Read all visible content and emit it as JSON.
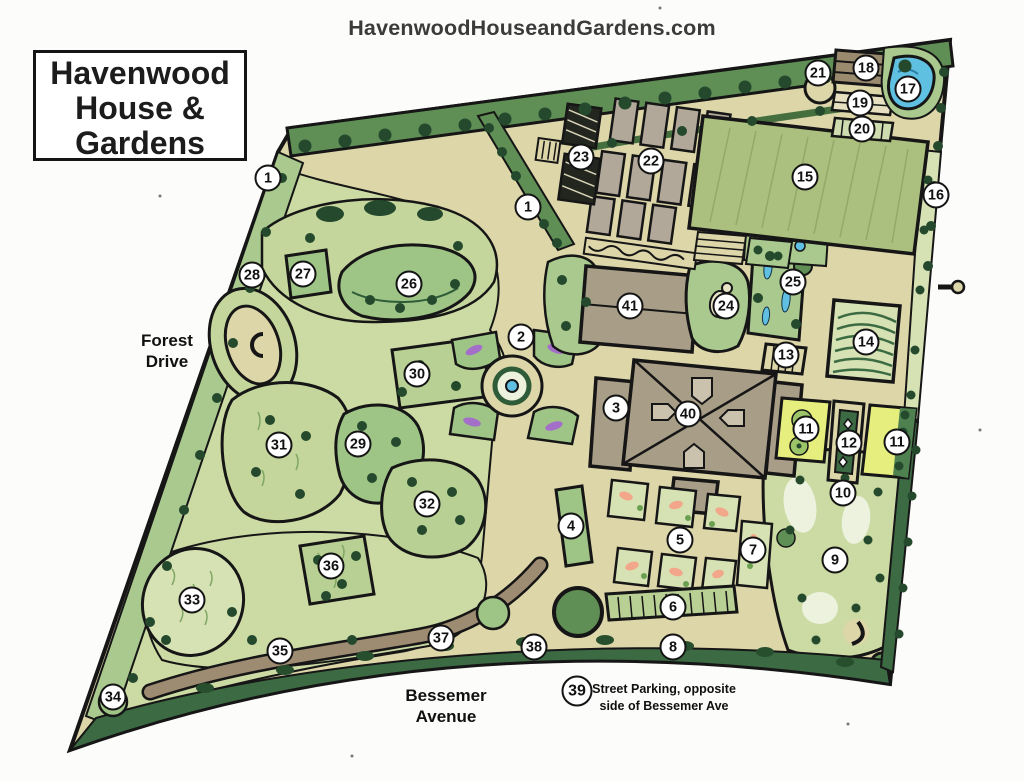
{
  "header": {
    "website": "HavenwoodHouseandGardens.com"
  },
  "title_box": {
    "line1": "Havenwood",
    "line2": "House &",
    "line3": "Gardens"
  },
  "roads": {
    "left": {
      "line1": "Forest",
      "line2": "Drive"
    },
    "bottom": {
      "line1": "Bessemer",
      "line2": "Avenue"
    }
  },
  "note": {
    "number": "39",
    "line1": "Street Parking, opposite",
    "line2": "side of Bessemer Ave"
  },
  "markers": [
    {
      "n": "1",
      "x": 268,
      "y": 178
    },
    {
      "n": "1",
      "x": 528,
      "y": 207
    },
    {
      "n": "2",
      "x": 521,
      "y": 337
    },
    {
      "n": "3",
      "x": 616,
      "y": 408
    },
    {
      "n": "4",
      "x": 571,
      "y": 526
    },
    {
      "n": "5",
      "x": 680,
      "y": 540
    },
    {
      "n": "6",
      "x": 673,
      "y": 607
    },
    {
      "n": "7",
      "x": 753,
      "y": 550
    },
    {
      "n": "8",
      "x": 673,
      "y": 647
    },
    {
      "n": "9",
      "x": 835,
      "y": 560
    },
    {
      "n": "10",
      "x": 843,
      "y": 493
    },
    {
      "n": "11",
      "x": 806,
      "y": 429
    },
    {
      "n": "11",
      "x": 897,
      "y": 442
    },
    {
      "n": "12",
      "x": 849,
      "y": 443
    },
    {
      "n": "13",
      "x": 786,
      "y": 355
    },
    {
      "n": "14",
      "x": 866,
      "y": 342
    },
    {
      "n": "15",
      "x": 805,
      "y": 177
    },
    {
      "n": "16",
      "x": 936,
      "y": 195
    },
    {
      "n": "17",
      "x": 908,
      "y": 89
    },
    {
      "n": "18",
      "x": 866,
      "y": 68
    },
    {
      "n": "19",
      "x": 860,
      "y": 103
    },
    {
      "n": "20",
      "x": 862,
      "y": 129
    },
    {
      "n": "21",
      "x": 818,
      "y": 73
    },
    {
      "n": "22",
      "x": 651,
      "y": 161
    },
    {
      "n": "23",
      "x": 581,
      "y": 157
    },
    {
      "n": "24",
      "x": 726,
      "y": 306
    },
    {
      "n": "25",
      "x": 793,
      "y": 282
    },
    {
      "n": "26",
      "x": 409,
      "y": 284
    },
    {
      "n": "27",
      "x": 303,
      "y": 274
    },
    {
      "n": "28",
      "x": 252,
      "y": 275
    },
    {
      "n": "29",
      "x": 358,
      "y": 444
    },
    {
      "n": "30",
      "x": 417,
      "y": 374
    },
    {
      "n": "31",
      "x": 279,
      "y": 445
    },
    {
      "n": "32",
      "x": 427,
      "y": 504
    },
    {
      "n": "33",
      "x": 192,
      "y": 600
    },
    {
      "n": "34",
      "x": 113,
      "y": 697
    },
    {
      "n": "35",
      "x": 280,
      "y": 651
    },
    {
      "n": "36",
      "x": 331,
      "y": 566
    },
    {
      "n": "37",
      "x": 441,
      "y": 638
    },
    {
      "n": "38",
      "x": 534,
      "y": 647
    },
    {
      "n": "39",
      "x": 577,
      "y": 691,
      "d": 31
    },
    {
      "n": "40",
      "x": 688,
      "y": 414
    },
    {
      "n": "41",
      "x": 630,
      "y": 306
    }
  ],
  "palette": {
    "paper": "#fcfcfa",
    "ink": "#161616",
    "tan": "#ddd6a9",
    "gpale": "#ccdaa4",
    "gpale2": "#d6e2b4",
    "glight": "#c5d69c",
    "glight2": "#b9d095",
    "gmid": "#9ec486",
    "gmid2": "#a9c98e",
    "hedge": "#5f8f55",
    "hedgedark": "#3c6a43",
    "treedot": "#24492c",
    "lawn": "#abbf7e",
    "bld": "#a89d87",
    "bld2": "#9a8a6e",
    "plot": "#b2a89a",
    "pale": "#edf2df",
    "water": "#5fc0e2",
    "yellow": "#e6ef7d",
    "purple": "#a36fc9",
    "peach": "#f2a78a",
    "trail": "#9d8b72",
    "dark": "#23261e"
  }
}
